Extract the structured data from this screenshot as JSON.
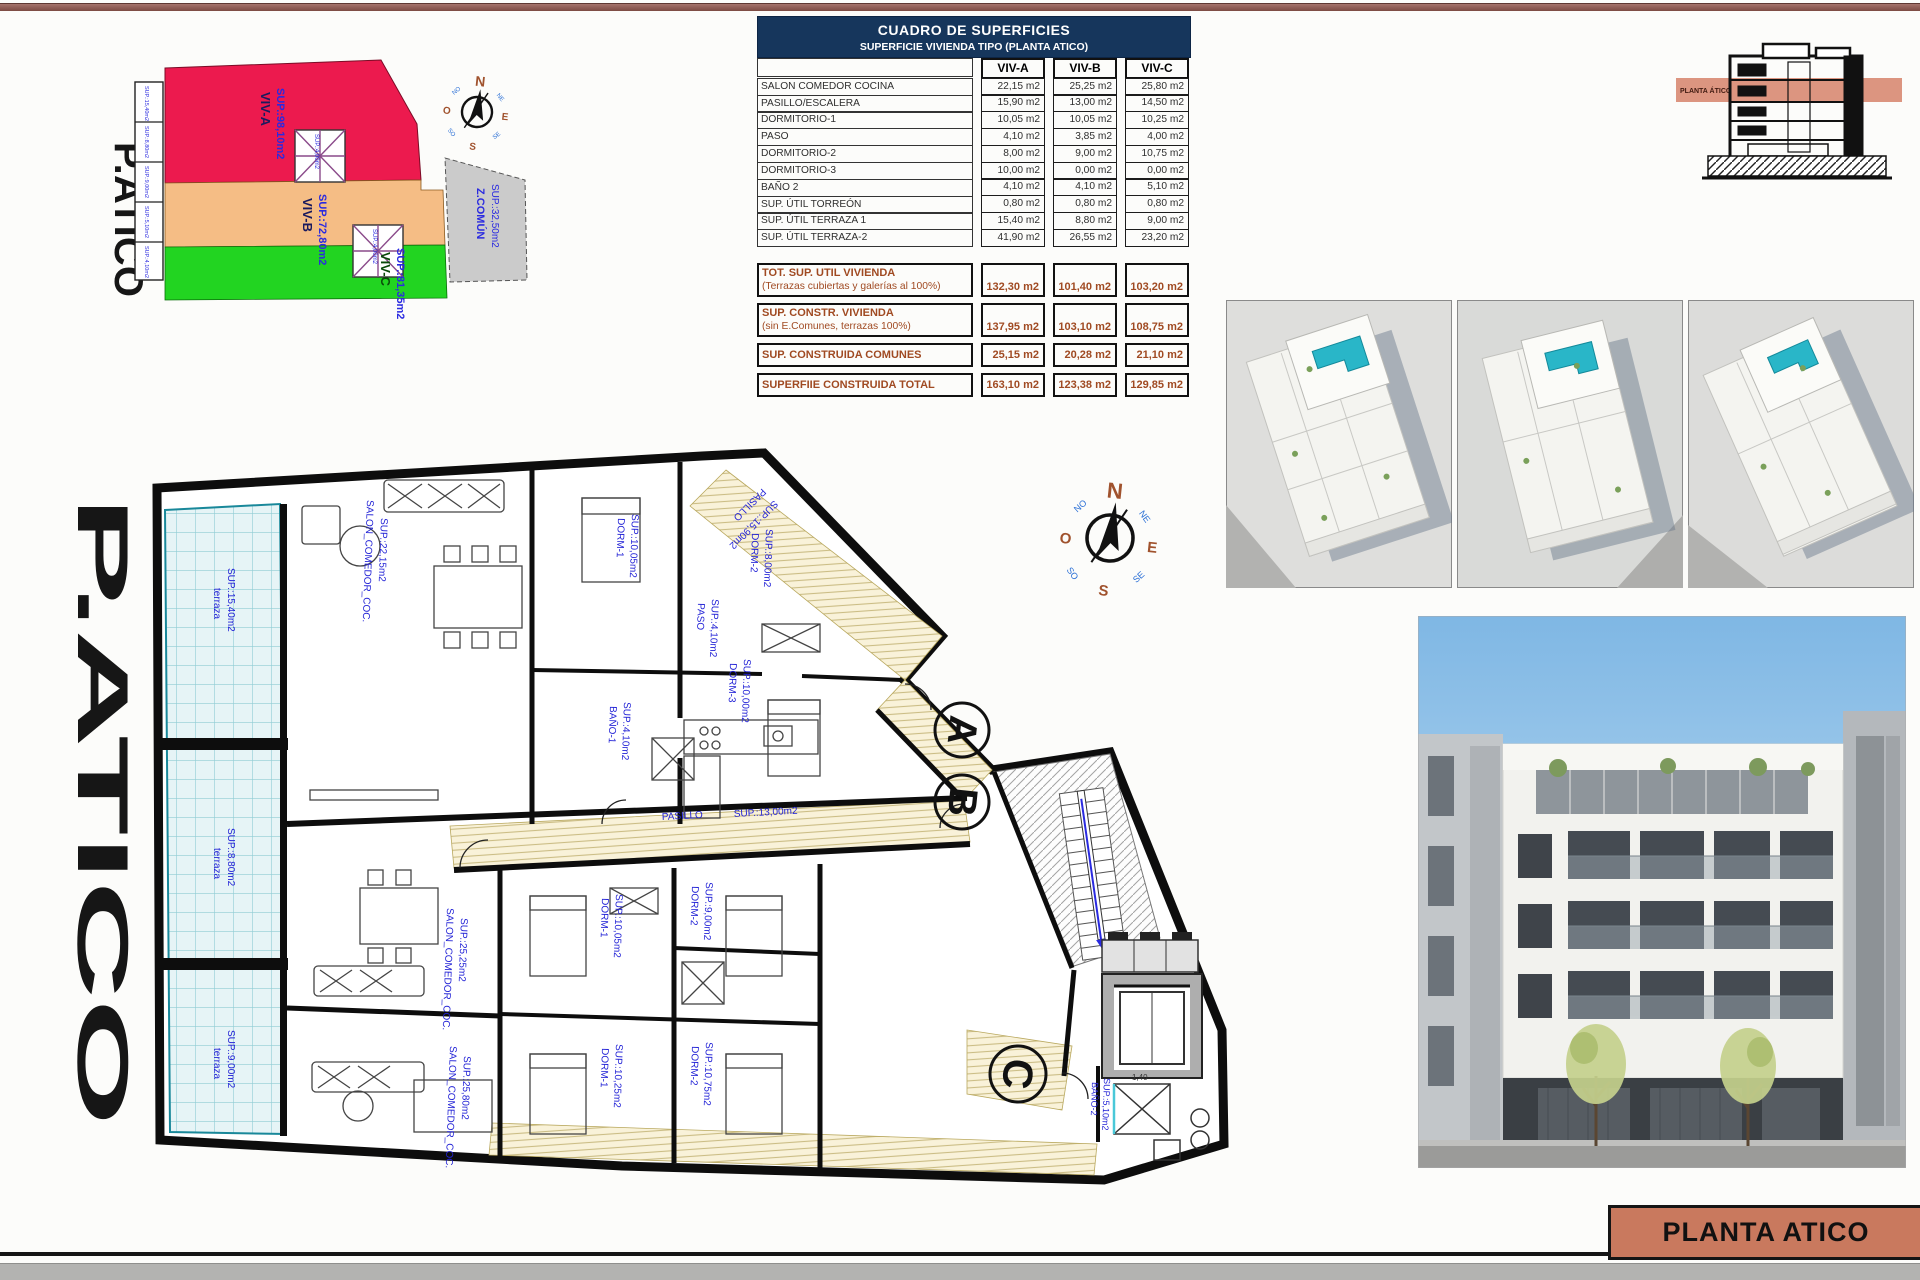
{
  "sheet": {
    "title_block": "PLANTA ATICO"
  },
  "compass": {
    "n": "N",
    "s": "S",
    "e": "E",
    "w": "O",
    "ne": "NE",
    "nw": "NO",
    "se": "SE",
    "sw": "SO"
  },
  "site_plan": {
    "floor_label": "P.ATICO",
    "units": [
      {
        "name": "VIV-A",
        "sup": "SUP.:98,10m2"
      },
      {
        "name": "VIV-B",
        "sup": "SUP.:72,80m2"
      },
      {
        "name": "VIV-C",
        "sup": "SUP.:81,35m2"
      },
      {
        "name": "Z.COMÚN",
        "sup": "SUP.:32,50m2"
      }
    ],
    "strip_labels": [
      "SUP.:15,40m2",
      "SUP.:8,80m2",
      "SUP.:9,00m2",
      "SUP.:5,10m2",
      "SUP.:4,10m2"
    ],
    "core_labels": [
      "SUP.:4,00m2",
      "SUP.:4,00m2"
    ]
  },
  "surface_table": {
    "title": "CUADRO DE SUPERFICIES",
    "subtitle": "SUPERFICIE VIVIENDA TIPO  (PLANTA ATICO)",
    "columns": [
      "VIV-A",
      "VIV-B",
      "VIV-C"
    ],
    "rows": [
      {
        "label": "SALON COMEDOR COCINA",
        "values": [
          "22,15 m2",
          "25,25 m2",
          "25,80 m2"
        ]
      },
      {
        "label": "PASILLO/ESCALERA",
        "values": [
          "15,90 m2",
          "13,00 m2",
          "14,50 m2"
        ]
      },
      {
        "label": "DORMITORIO-1",
        "values": [
          "10,05 m2",
          "10,05 m2",
          "10,25 m2"
        ]
      },
      {
        "label": "PASO",
        "values": [
          "4,10 m2",
          "3,85 m2",
          "4,00 m2"
        ]
      },
      {
        "label": "DORMITORIO-2",
        "values": [
          "8,00 m2",
          "9,00 m2",
          "10,75 m2"
        ]
      },
      {
        "label": "DORMITORIO-3",
        "values": [
          "10,00 m2",
          "0,00 m2",
          "0,00 m2"
        ]
      },
      {
        "label": "BAÑO 2",
        "values": [
          "4,10 m2",
          "4,10 m2",
          "5,10 m2"
        ]
      },
      {
        "label": "SUP. ÚTIL TORREÓN",
        "values": [
          "0,80 m2",
          "0,80 m2",
          "0,80 m2"
        ]
      },
      {
        "label": "SUP. ÚTIL TERRAZA 1",
        "values": [
          "15,40 m2",
          "8,80 m2",
          "9,00 m2"
        ]
      },
      {
        "label": "SUP. ÚTIL TERRAZA-2",
        "values": [
          "41,90 m2",
          "26,55 m2",
          "23,20 m2"
        ]
      }
    ],
    "summary": [
      {
        "label": "TOT. SUP. UTIL VIVIENDA",
        "sublabel": "(Terrazas cubiertas y galerías al 100%)",
        "values": [
          "132,30 m2",
          "101,40 m2",
          "103,20 m2"
        ]
      },
      {
        "label": "SUP. CONSTR. VIVIENDA",
        "sublabel": "(sin E.Comunes, terrazas 100%)",
        "values": [
          "137,95 m2",
          "103,10 m2",
          "108,75 m2"
        ]
      },
      {
        "label": "SUP. CONSTRUIDA COMUNES",
        "sublabel": "",
        "values": [
          "25,15 m2",
          "20,28 m2",
          "21,10 m2"
        ]
      },
      {
        "label": "SUPERFIIE CONSTRUIDA TOTAL",
        "sublabel": "",
        "values": [
          "163,10 m2",
          "123,38 m2",
          "129,85 m2"
        ]
      }
    ]
  },
  "section": {
    "band_label": "PLANTA ÁTICO"
  },
  "floor_plan": {
    "floor_label": "P.ATICO",
    "entries": [
      "A",
      "B",
      "C"
    ],
    "labels": {
      "terraza": "terraza",
      "t1": "SUP.:15,40m2",
      "t2": "SUP.:8,80m2",
      "t3": "SUP.:9,00m2",
      "salon": "SALON_COMEDOR_COC.",
      "salonA_sup": "SUP.:22,15m2",
      "salonB_sup": "SUP.:25,25m2",
      "salonC_sup": "SUP.:25,80m2",
      "dorm1": "DORM-1",
      "dorm2": "DORM-2",
      "dorm3": "DORM-3",
      "dorm1A_sup": "SUP.:10,05m2",
      "dorm2A_sup": "SUP.:8,00m2",
      "dorm3A_sup": "SUP.:10,00m2",
      "dorm1B_sup": "SUP.:10,05m2",
      "dorm2B_sup": "SUP.:9,00m2",
      "dorm1C_sup": "SUP.:10,25m2",
      "dorm2C_sup": "SUP.:10,75m2",
      "banyo1": "BAÑO-1",
      "banyo1_sup": "SUP.:4,10m2",
      "banyo2": "BAÑO-2",
      "banyo2_sup": "SUP.:5,10m2",
      "paso": "PASO",
      "paso_sup": "SUP.:4,10m2",
      "pasillo": "PASILLO",
      "pasilloA_sup": "SUP.:15,90m2",
      "pasilloB_sup": "SUP.:13,00m2",
      "dim": "1,40"
    }
  }
}
